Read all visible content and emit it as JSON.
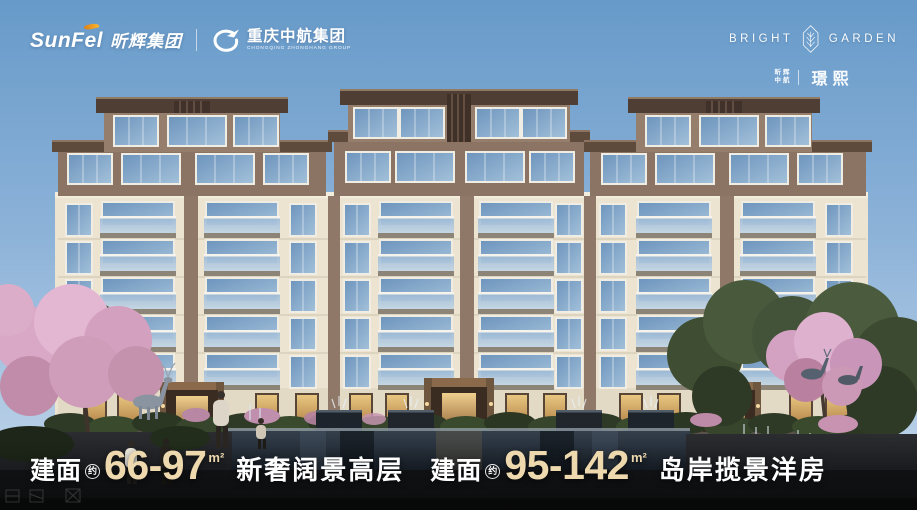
{
  "header": {
    "left": {
      "sunfel_en": "SunFel",
      "sunfel_cn": "昕辉集团",
      "group_cn": "重庆中航集团",
      "group_en": "CHONGQING ZHONGHANG GROUP"
    },
    "right": {
      "brand_word_1": "BRIGHT",
      "brand_word_2": "GARDEN",
      "owner_line_1": "昕辉",
      "owner_line_2": "中航",
      "project_name": "璟熙"
    }
  },
  "footer": {
    "highrise": {
      "label": "建面",
      "approx": "约",
      "range": "66-97",
      "unit": "m²",
      "tagline": "新奢阔景高层"
    },
    "mansion": {
      "label": "建面",
      "approx": "约",
      "range": "95-142",
      "unit": "m²",
      "tagline": "岛岸揽景洋房"
    }
  },
  "colors": {
    "accent_orange": "#f0a31b",
    "number_champagne": "#eed9af",
    "sky_top": "#679ac9",
    "sky_horizon": "#c8daec",
    "facade_cream": "#ece4d1",
    "facade_brown": "#8f7867",
    "roof_brown": "#4f3e33",
    "window_glass": "#7d9fc4",
    "blossom_pink": "#d8a8c6",
    "pool_dark": "#10161d",
    "text_white": "#ffffff"
  }
}
